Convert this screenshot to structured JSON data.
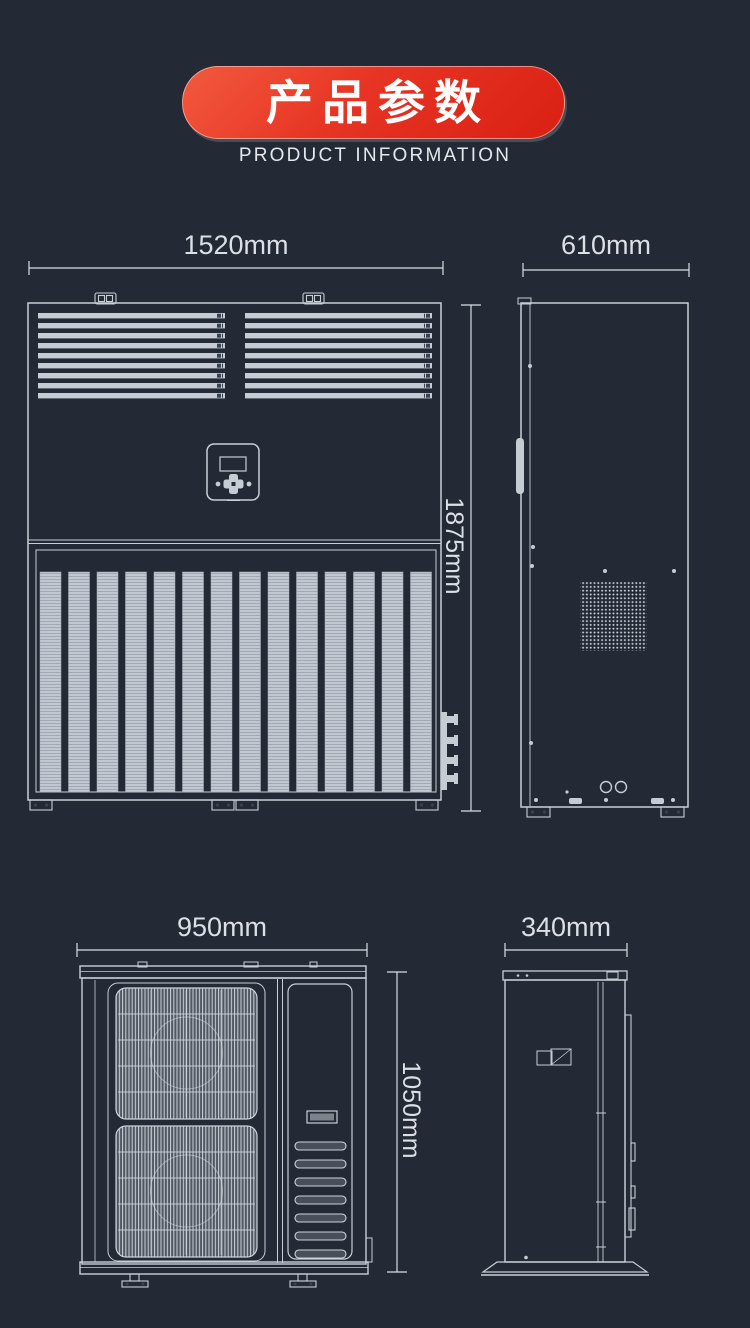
{
  "header": {
    "title": "产品参数",
    "subtitle": "PRODUCT INFORMATION"
  },
  "colors": {
    "page_background": "#232a36",
    "banner_red_light": "#f25a3e",
    "banner_red_dark": "#d92013",
    "banner_text": "#ffffff",
    "drawing_line": "#c9ced6",
    "drawing_fill": "#c6ccd4",
    "dimension_text": "#dcdfe5"
  },
  "drawings": {
    "indoor_unit_front": {
      "label_width": "1520mm",
      "label_height": "1875mm"
    },
    "indoor_unit_side": {
      "label_depth": "610mm"
    },
    "outdoor_unit_front": {
      "label_width": "950mm",
      "label_height": "1050mm"
    },
    "outdoor_unit_side": {
      "label_depth": "340mm"
    }
  }
}
